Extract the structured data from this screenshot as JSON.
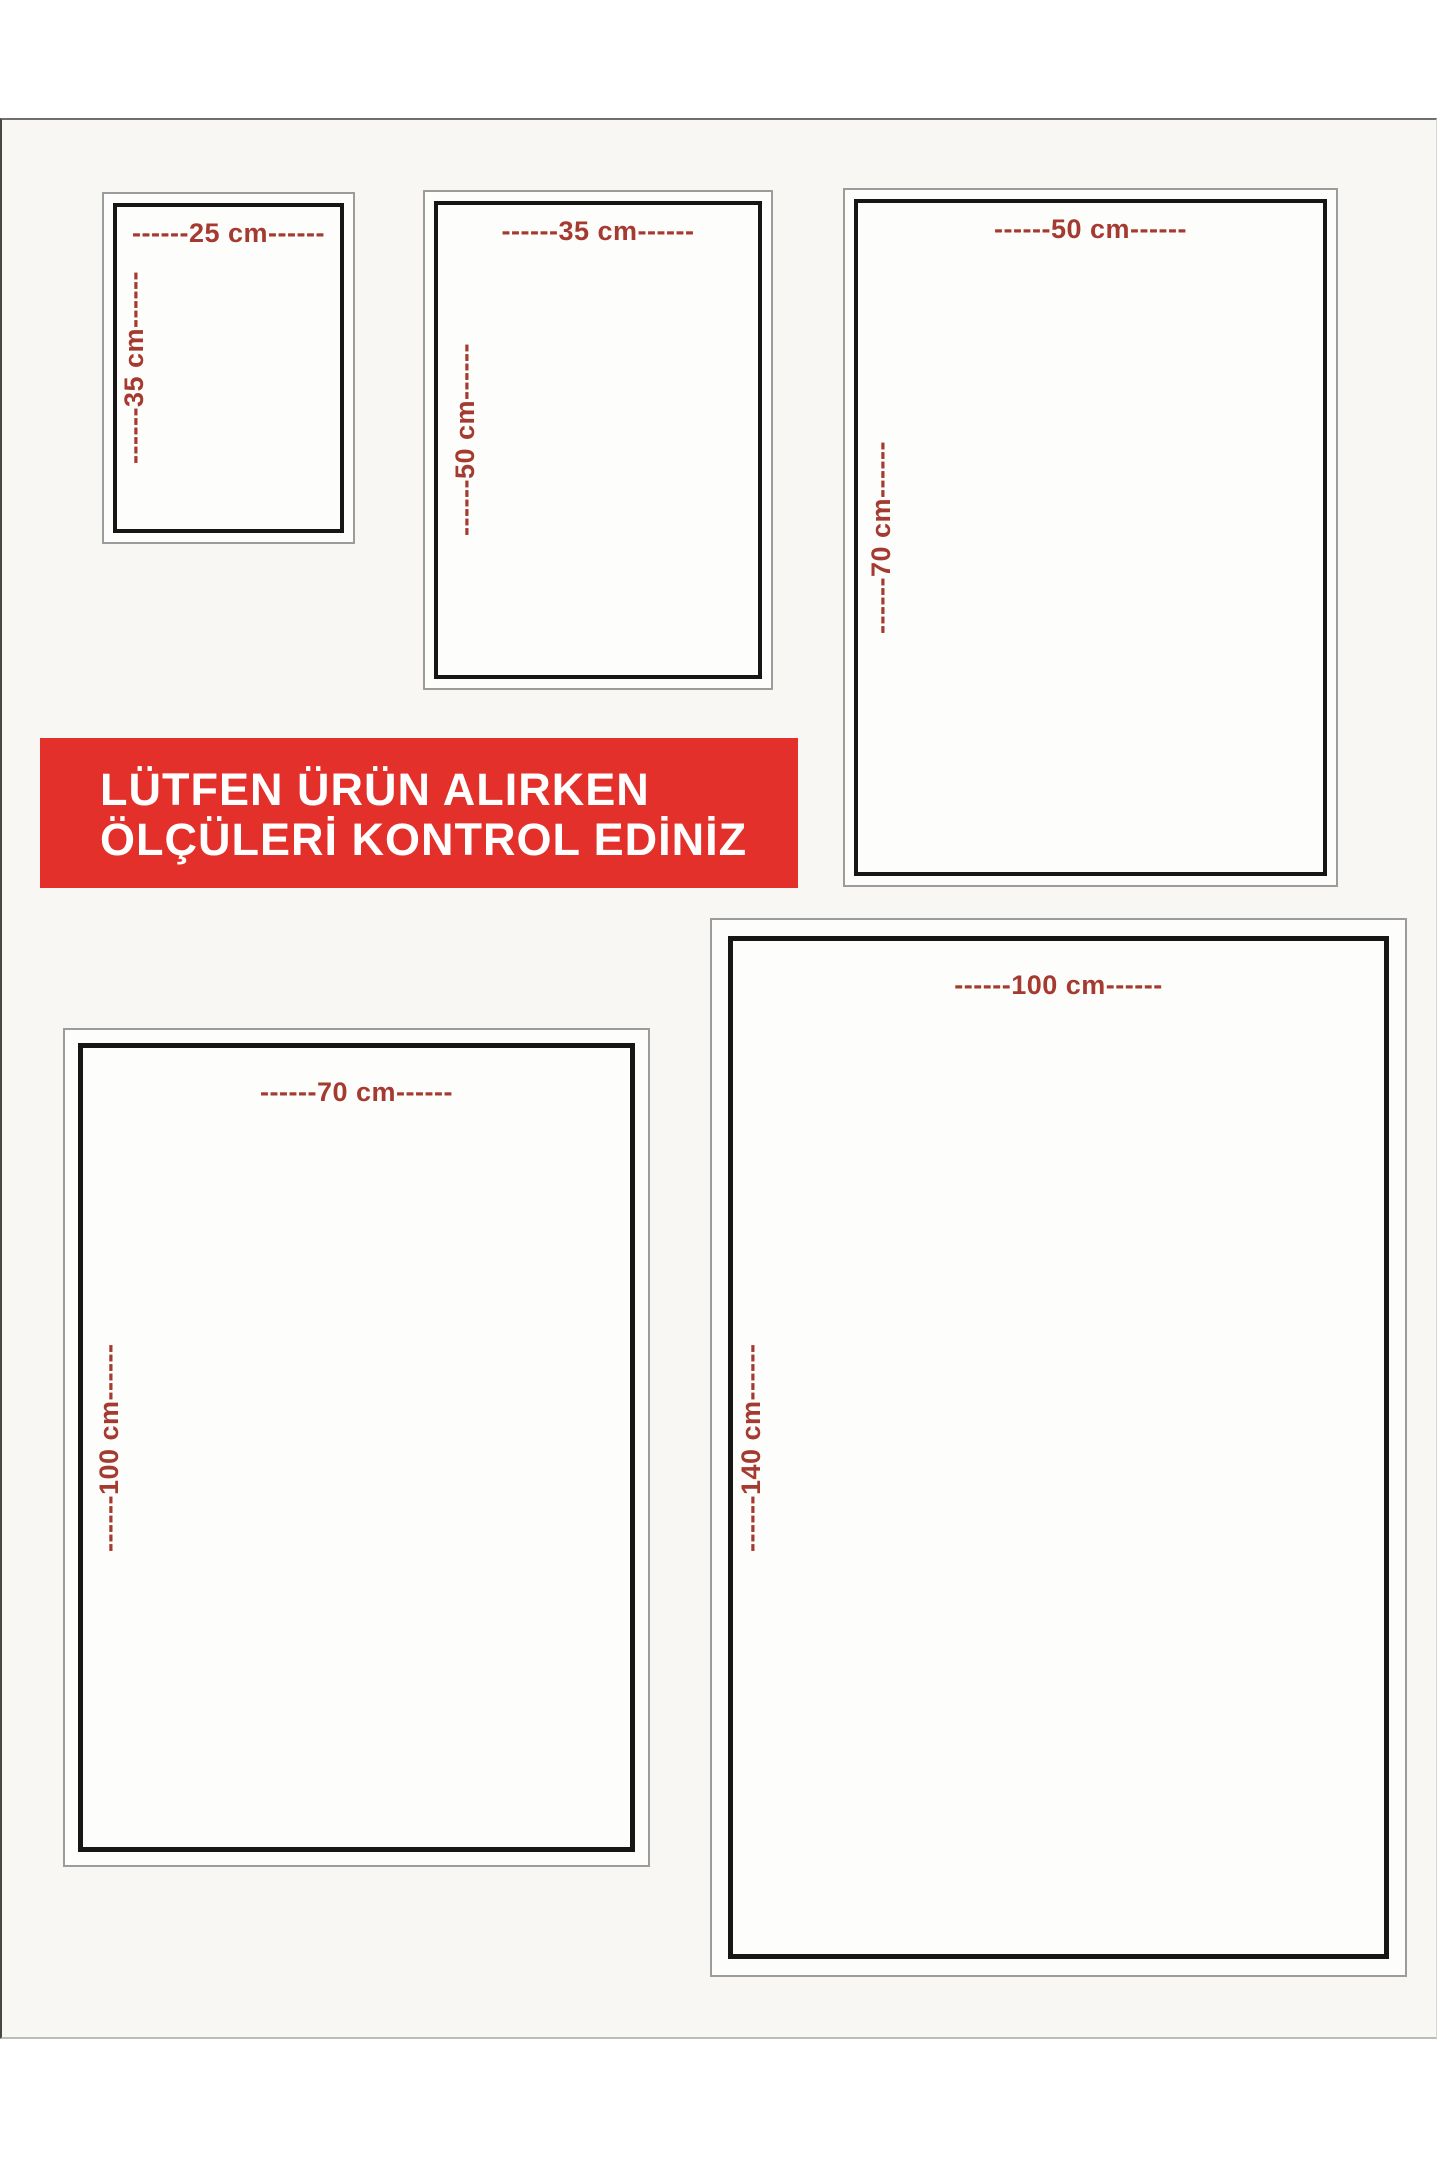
{
  "banner": {
    "line1": "LÜTFEN ÜRÜN ALIRKEN",
    "line2": "ÖLÇÜLERİ KONTROL EDİNİZ"
  },
  "sizes": [
    {
      "name": "25x35",
      "width_cm": 25,
      "height_cm": 35,
      "width_label": "------25 cm------",
      "height_label": "------35 cm------"
    },
    {
      "name": "35x50",
      "width_cm": 35,
      "height_cm": 50,
      "width_label": "------35 cm------",
      "height_label": "------50 cm------"
    },
    {
      "name": "50x70",
      "width_cm": 50,
      "height_cm": 70,
      "width_label": "------50 cm------",
      "height_label": "------70 cm------"
    },
    {
      "name": "70x100",
      "width_cm": 70,
      "height_cm": 100,
      "width_label": "------70 cm------",
      "height_label": "------100 cm------"
    },
    {
      "name": "100x140",
      "width_cm": 100,
      "height_cm": 140,
      "width_label": "------100 cm------",
      "height_label": "------140 cm------"
    }
  ],
  "colors": {
    "banner_bg": "#e3302a",
    "banner_text": "#ffffff",
    "dimension_text": "#a53a30",
    "frame_border": "#161616",
    "outer_border": "#9c9c9c",
    "page_bg": "#f8f7f4"
  }
}
